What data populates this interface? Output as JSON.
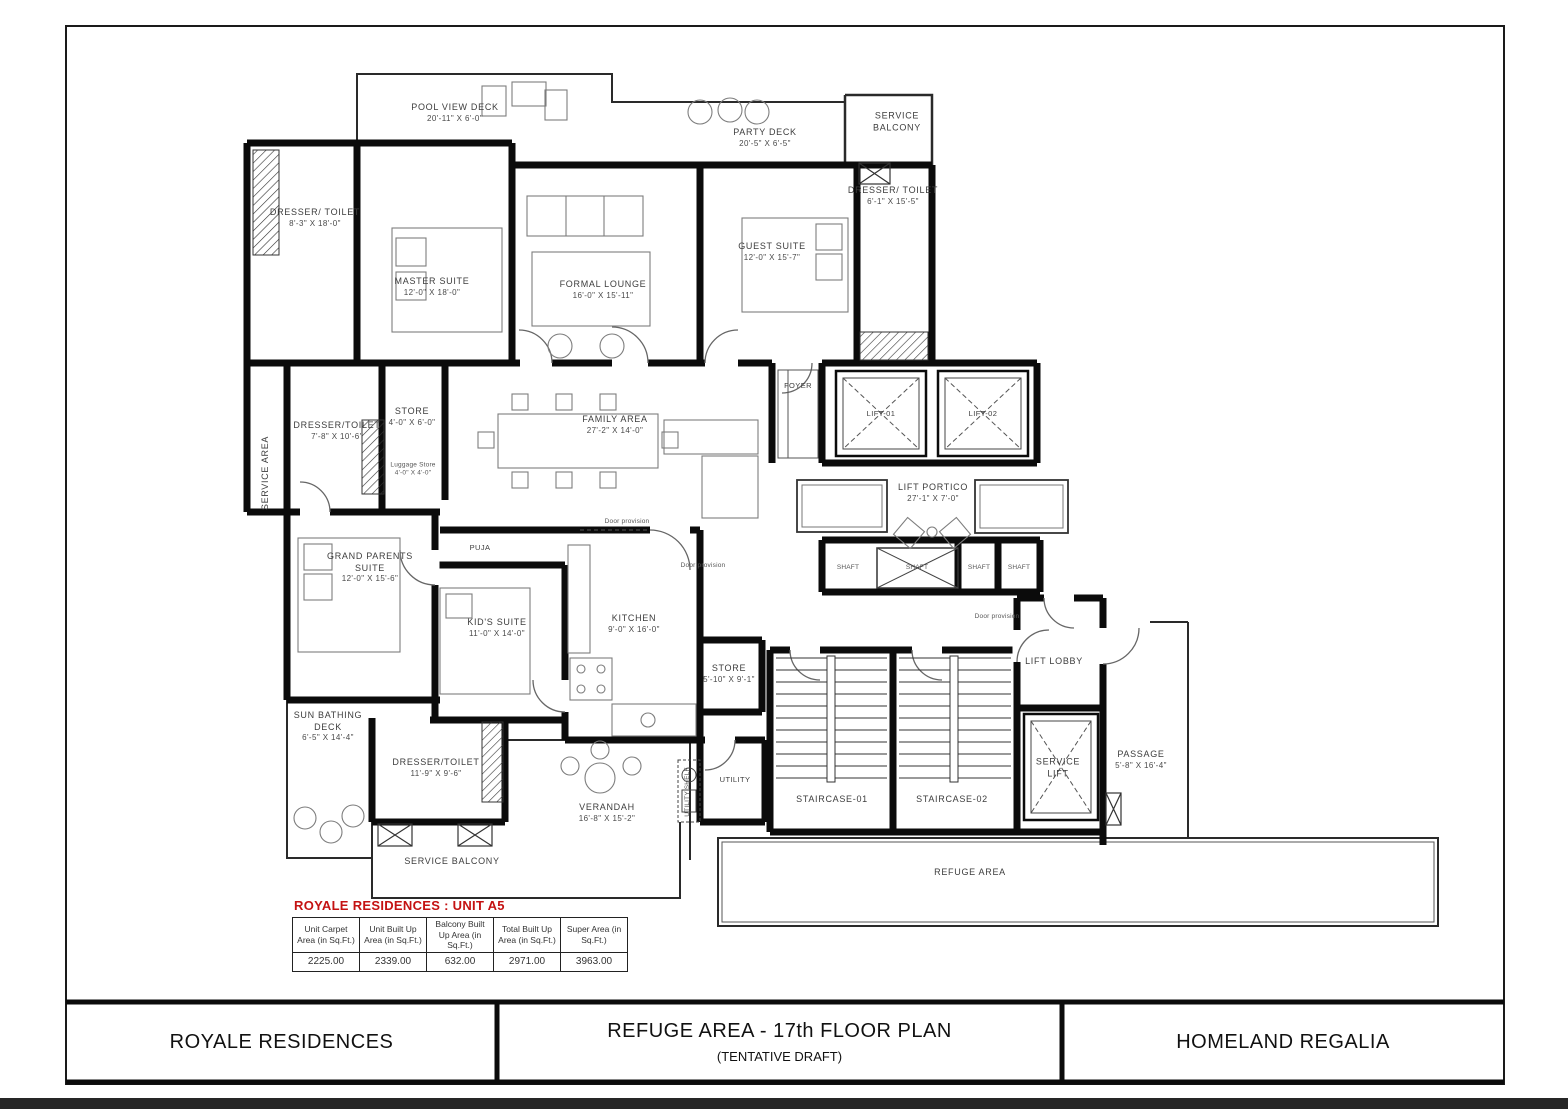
{
  "title_block": {
    "left": "ROYALE RESIDENCES",
    "center_line1": "REFUGE AREA - 17th FLOOR PLAN",
    "center_line2": "(TENTATIVE DRAFT)",
    "right": "HOMELAND REGALIA"
  },
  "unit_table": {
    "title": "ROYALE RESIDENCES : UNIT A5",
    "headers": [
      "Unit Carpet Area (in Sq.Ft.)",
      "Unit Built Up Area (in Sq.Ft.)",
      "Balcony Built Up Area (in Sq.Ft.)",
      "Total Built Up Area (in Sq.Ft.)",
      "Super Area (in Sq.Ft.)"
    ],
    "values": [
      "2225.00",
      "2339.00",
      "632.00",
      "2971.00",
      "3963.00"
    ]
  },
  "colors": {
    "table_title_red": "#c41212",
    "wall_black": "#0b0b0b"
  },
  "rooms": [
    {
      "name": "POOL VIEW DECK",
      "dims": "20'-11\" X 6'-0\""
    },
    {
      "name": "PARTY DECK",
      "dims": "20'-5\" X 6'-5\""
    },
    {
      "name": "SERVICE BALCONY",
      "dims": ""
    },
    {
      "name": "DRESSER/ TOILET",
      "dims": "8'-3\" X 18'-0\""
    },
    {
      "name": "MASTER SUITE",
      "dims": "12'-0\" X 18'-0\""
    },
    {
      "name": "FORMAL LOUNGE",
      "dims": "16'-0\" X 15'-11\""
    },
    {
      "name": "GUEST SUITE",
      "dims": "12'-0\" X 15'-7\""
    },
    {
      "name": "DRESSER/ TOILET",
      "dims": "6'-1\" X 15'-5\""
    },
    {
      "name": "FOYER",
      "dims": ""
    },
    {
      "name": "LIFT-01",
      "dims": ""
    },
    {
      "name": "LIFT-02",
      "dims": ""
    },
    {
      "name": "SERVICE AREA",
      "dims": ""
    },
    {
      "name": "DRESSER/TOILET",
      "dims": "7'-8\" X 10'-6\""
    },
    {
      "name": "STORE",
      "dims": "4'-0\" X 6'-0\""
    },
    {
      "name": "Luggage Store",
      "dims": "4'-0\" X 4'-0\""
    },
    {
      "name": "FAMILY AREA",
      "dims": "27'-2\" X 14'-0\""
    },
    {
      "name": "LIFT PORTICO",
      "dims": "27'-1\" X 7'-0\""
    },
    {
      "name": "PUJA",
      "dims": ""
    },
    {
      "name": "GRAND PARENTS SUITE",
      "dims": "12'-0\" X 15'-6\""
    },
    {
      "name": "KID'S SUITE",
      "dims": "11'-0\" X 14'-0\""
    },
    {
      "name": "KITCHEN",
      "dims": "9'-0\" X 16'-0\""
    },
    {
      "name": "SHAFT",
      "dims": ""
    },
    {
      "name": "SHAFT",
      "dims": ""
    },
    {
      "name": "SHAFT",
      "dims": ""
    },
    {
      "name": "SHAFT",
      "dims": ""
    },
    {
      "name": "Door provision",
      "dims": ""
    },
    {
      "name": "Door provision",
      "dims": ""
    },
    {
      "name": "Door provision",
      "dims": ""
    },
    {
      "name": "STORE",
      "dims": "5'-10\" X 9'-1\""
    },
    {
      "name": "UTILITY",
      "dims": ""
    },
    {
      "name": "UTILITY SHELF",
      "dims": ""
    },
    {
      "name": "STAIRCASE-01",
      "dims": ""
    },
    {
      "name": "STAIRCASE-02",
      "dims": ""
    },
    {
      "name": "LIFT LOBBY",
      "dims": ""
    },
    {
      "name": "SERVICE LIFT",
      "dims": ""
    },
    {
      "name": "PASSAGE",
      "dims": "5'-8\" X 16'-4\""
    },
    {
      "name": "SUN BATHING DECK",
      "dims": "6'-5\" X 14'-4\""
    },
    {
      "name": "DRESSER/TOILET",
      "dims": "11'-9\" X 9'-6\""
    },
    {
      "name": "SERVICE BALCONY",
      "dims": ""
    },
    {
      "name": "VERANDAH",
      "dims": "16'-8\" X 15'-2\""
    },
    {
      "name": "REFUGE AREA",
      "dims": ""
    }
  ]
}
